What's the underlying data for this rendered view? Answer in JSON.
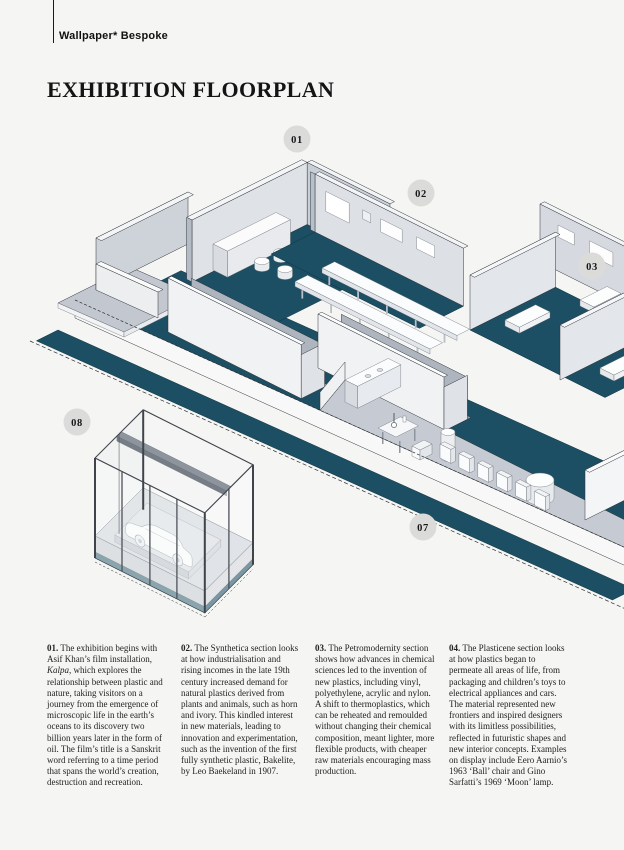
{
  "page": {
    "background": "#f5f5f3"
  },
  "header": {
    "brand": "Wallpaper* Bespoke",
    "title": "EXHIBITION FLOORPLAN"
  },
  "floorplan": {
    "colors": {
      "floor_teal": "#1c4f63",
      "wall_light": "#e4e7ea",
      "wall_mid": "#ccd1d8",
      "platform_gray": "#c6cbd3",
      "callout_bg": "#dbdbda"
    },
    "callouts": [
      {
        "label": "01"
      },
      {
        "label": "02"
      },
      {
        "label": "03"
      },
      {
        "label": "07"
      },
      {
        "label": "08"
      }
    ]
  },
  "legend": {
    "columns": [
      {
        "num": "01.",
        "text_pre": " The exhibition begins with Asif Khan’s film installation, ",
        "text_italic": "Kalpa",
        "text_post": ", which explores the relationship between plastic and nature, taking visitors on a journey from the emergence of microscopic life in the earth’s oceans to its discovery two billion years later in the form of oil. The film’s title is a Sanskrit word referring to a time period that spans the world’s creation, destruction and recreation."
      },
      {
        "num": "02.",
        "text": " The Synthetica section looks at how industrialisation and rising incomes in the late 19th century increased demand for natural plastics derived from plants and animals, such as horn and ivory. This kindled interest in new materials, leading to innovation and experimentation, such as the invention of the first fully synthetic plastic, Bakelite, by Leo Baekeland in 1907."
      },
      {
        "num": "03.",
        "text": " The Petromodernity section shows how advances in chemical sciences led to the invention of new plastics, including vinyl, polyethylene, acrylic and nylon. A shift to thermoplastics, which can be reheated and remoulded without changing their chemical composition, meant lighter, more flexible products, with cheaper raw materials encouraging mass production."
      },
      {
        "num": "04.",
        "text": " The Plasticene section looks at how plastics began to permeate all areas of life, from packaging and children’s toys to electrical appliances and cars. The material represented new frontiers and inspired designers with its limitless possibilities, reflected in futuristic shapes and new interior concepts. Examples on display include Eero Aarnio’s 1963 ‘Ball’ chair and Gino Sarfatti’s 1969 ‘Moon’ lamp."
      }
    ]
  }
}
